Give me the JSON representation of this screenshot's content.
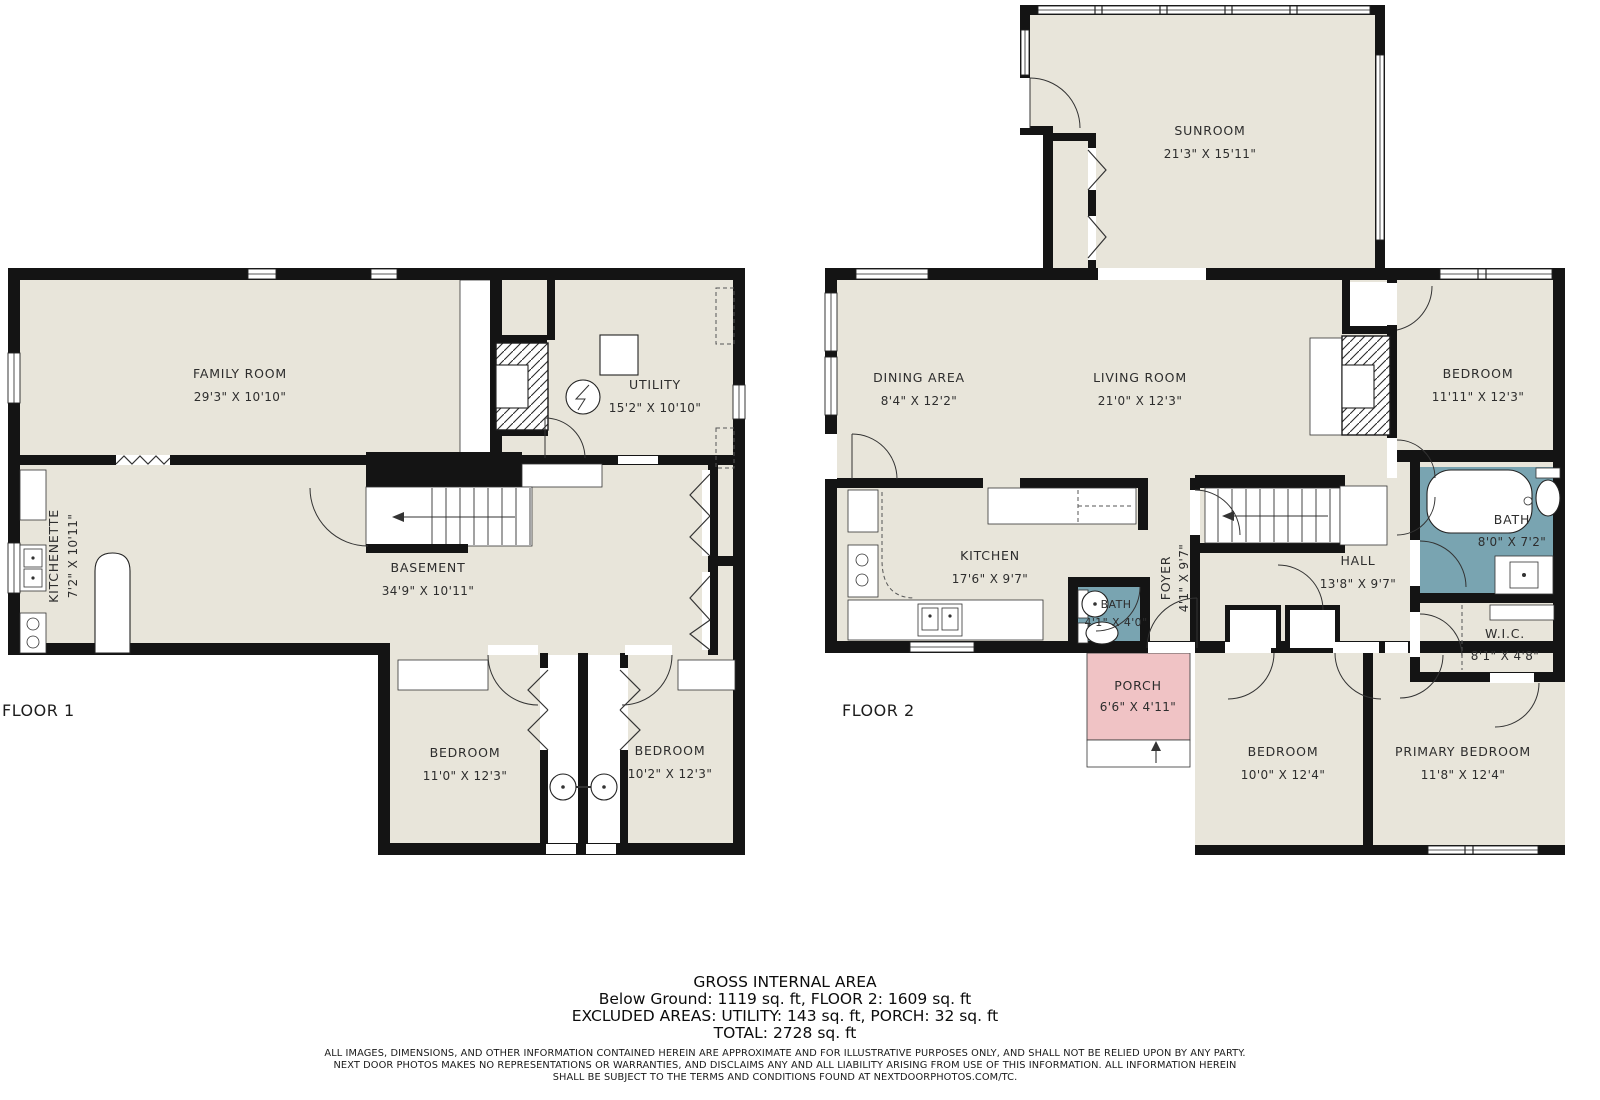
{
  "colors": {
    "wall": "#141414",
    "room_fill": "#e8e5da",
    "bath_fill": "#79a4b1",
    "porch_fill": "#f0c3c5",
    "background": "#ffffff"
  },
  "floor1": {
    "label": "FLOOR 1",
    "rooms": {
      "family_room": {
        "name": "FAMILY ROOM",
        "dims": "29'3\" X 10'10\""
      },
      "utility": {
        "name": "UTILITY",
        "dims": "15'2\" X 10'10\""
      },
      "kitchenette": {
        "name": "KITCHENETTE",
        "dims": "7'2\" X 10'11\""
      },
      "basement": {
        "name": "BASEMENT",
        "dims": "34'9\" X 10'11\""
      },
      "bedroom_left": {
        "name": "BEDROOM",
        "dims": "11'0\" X 12'3\""
      },
      "bedroom_right": {
        "name": "BEDROOM",
        "dims": "10'2\" X 12'3\""
      }
    }
  },
  "floor2": {
    "label": "FLOOR 2",
    "rooms": {
      "sunroom": {
        "name": "SUNROOM",
        "dims": "21'3\" X 15'11\""
      },
      "dining_area": {
        "name": "DINING AREA",
        "dims": "8'4\" X 12'2\""
      },
      "living_room": {
        "name": "LIVING ROOM",
        "dims": "21'0\" X 12'3\""
      },
      "bedroom_top": {
        "name": "BEDROOM",
        "dims": "11'11\" X 12'3\""
      },
      "kitchen": {
        "name": "KITCHEN",
        "dims": "17'6\" X 9'7\""
      },
      "foyer": {
        "name": "FOYER",
        "dims": "4'1\" X 9'7\""
      },
      "bath_small": {
        "name": "BATH",
        "dims": "4'1\" X 4'0\""
      },
      "hall": {
        "name": "HALL",
        "dims": "13'8\" X 9'7\""
      },
      "bath": {
        "name": "BATH",
        "dims": "8'0\" X 7'2\""
      },
      "wic": {
        "name": "W.I.C.",
        "dims": "8'1\" X 4'8\""
      },
      "porch": {
        "name": "PORCH",
        "dims": "6'6\" X 4'11\""
      },
      "bedroom_bottom": {
        "name": "BEDROOM",
        "dims": "10'0\" X 12'4\""
      },
      "primary_bedroom": {
        "name": "PRIMARY BEDROOM",
        "dims": "11'8\" X 12'4\""
      }
    }
  },
  "summary": {
    "title": "GROSS INTERNAL AREA",
    "line1": "Below Ground: 1119 sq. ft, FLOOR 2: 1609 sq. ft",
    "line2": "EXCLUDED AREAS: UTILITY: 143 sq. ft, PORCH: 32 sq. ft",
    "line3": "TOTAL: 2728 sq. ft"
  },
  "disclaimer": {
    "line1": "ALL IMAGES, DIMENSIONS, AND OTHER INFORMATION CONTAINED HEREIN ARE APPROXIMATE AND FOR ILLUSTRATIVE PURPOSES ONLY, AND SHALL NOT BE RELIED UPON BY ANY PARTY.",
    "line2": "NEXT DOOR PHOTOS MAKES NO REPRESENTATIONS OR WARRANTIES, AND DISCLAIMS ANY AND ALL LIABILITY ARISING FROM USE OF THIS INFORMATION. ALL INFORMATION HEREIN",
    "line3": "SHALL BE SUBJECT TO THE TERMS AND CONDITIONS FOUND AT NEXTDOORPHOTOS.COM/TC."
  }
}
